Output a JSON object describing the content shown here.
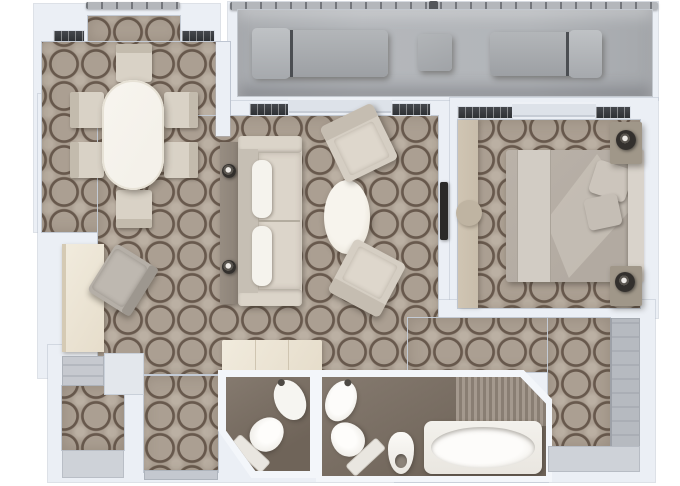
{
  "scene": "suite-floor-plan",
  "palette": {
    "page": "#ffffff",
    "wall": "#ebeff5",
    "wall-edge": "#c3cad4",
    "carpet": "#ab9f92",
    "carpet-line": "#68594d",
    "carpet-light": "#bbb0a3",
    "deck": "#b4b7bb",
    "rail-dark": "#74777c",
    "lounger": "#a8abaf",
    "bath-floor": "#6f6459",
    "fixture": "#f6f5f1",
    "cream": "#e6ddcb",
    "sofa-frame": "#d2cbc0",
    "sofa-cushion": "#dcd5ca",
    "pillow-white": "#f5f3ed",
    "bed": "#b2aaa1",
    "bed-throw": "#d2ccc4",
    "headboard": "#d9d3cb",
    "console-wood": "#8c8277",
    "lamp-dark": "#33302d",
    "tan-dresser": "#c8bdab",
    "closet-gray": "#b6bac0",
    "mat-gray": "#ced2d8",
    "window-dark": "#45484d",
    "stripe-a": "#a4998e",
    "stripe-b": "#897e73",
    "tv-dark": "#2b2a29",
    "dining-chair": "#d9d2c6",
    "table-white": "#f4f1ea"
  },
  "rooms": [
    {
      "id": "veranda",
      "furniture": [
        "sun-lounger",
        "side-table",
        "sun-lounger"
      ]
    },
    {
      "id": "dining-area",
      "furniture": [
        "oval-dining-table",
        "dining-chair",
        "dining-chair",
        "dining-chair",
        "dining-chair",
        "dining-chair",
        "dining-chair"
      ]
    },
    {
      "id": "living-area",
      "furniture": [
        "sofa",
        "sofa-pillow",
        "sofa-pillow",
        "console-table",
        "table-lamp",
        "table-lamp",
        "oval-coffee-table",
        "armchair",
        "armchair",
        "storage-bench",
        "writing-desk",
        "desk-chair",
        "wall-tv"
      ]
    },
    {
      "id": "bedroom",
      "furniture": [
        "double-bed",
        "bed-pillow",
        "bed-pillow",
        "headboard",
        "nightstand",
        "bedside-lamp",
        "nightstand",
        "bedside-lamp",
        "low-dresser"
      ]
    },
    {
      "id": "entry-hall",
      "furniture": [
        "closet",
        "cabinet",
        "door-mat"
      ]
    },
    {
      "id": "guest-bathroom",
      "furniture": [
        "washbasin",
        "toilet"
      ]
    },
    {
      "id": "master-bathroom",
      "furniture": [
        "washbasin",
        "toilet",
        "bidet",
        "bathtub",
        "towel-deck"
      ]
    },
    {
      "id": "walk-in-wardrobe",
      "furniture": [
        "wardrobe",
        "floor-mat"
      ]
    }
  ]
}
